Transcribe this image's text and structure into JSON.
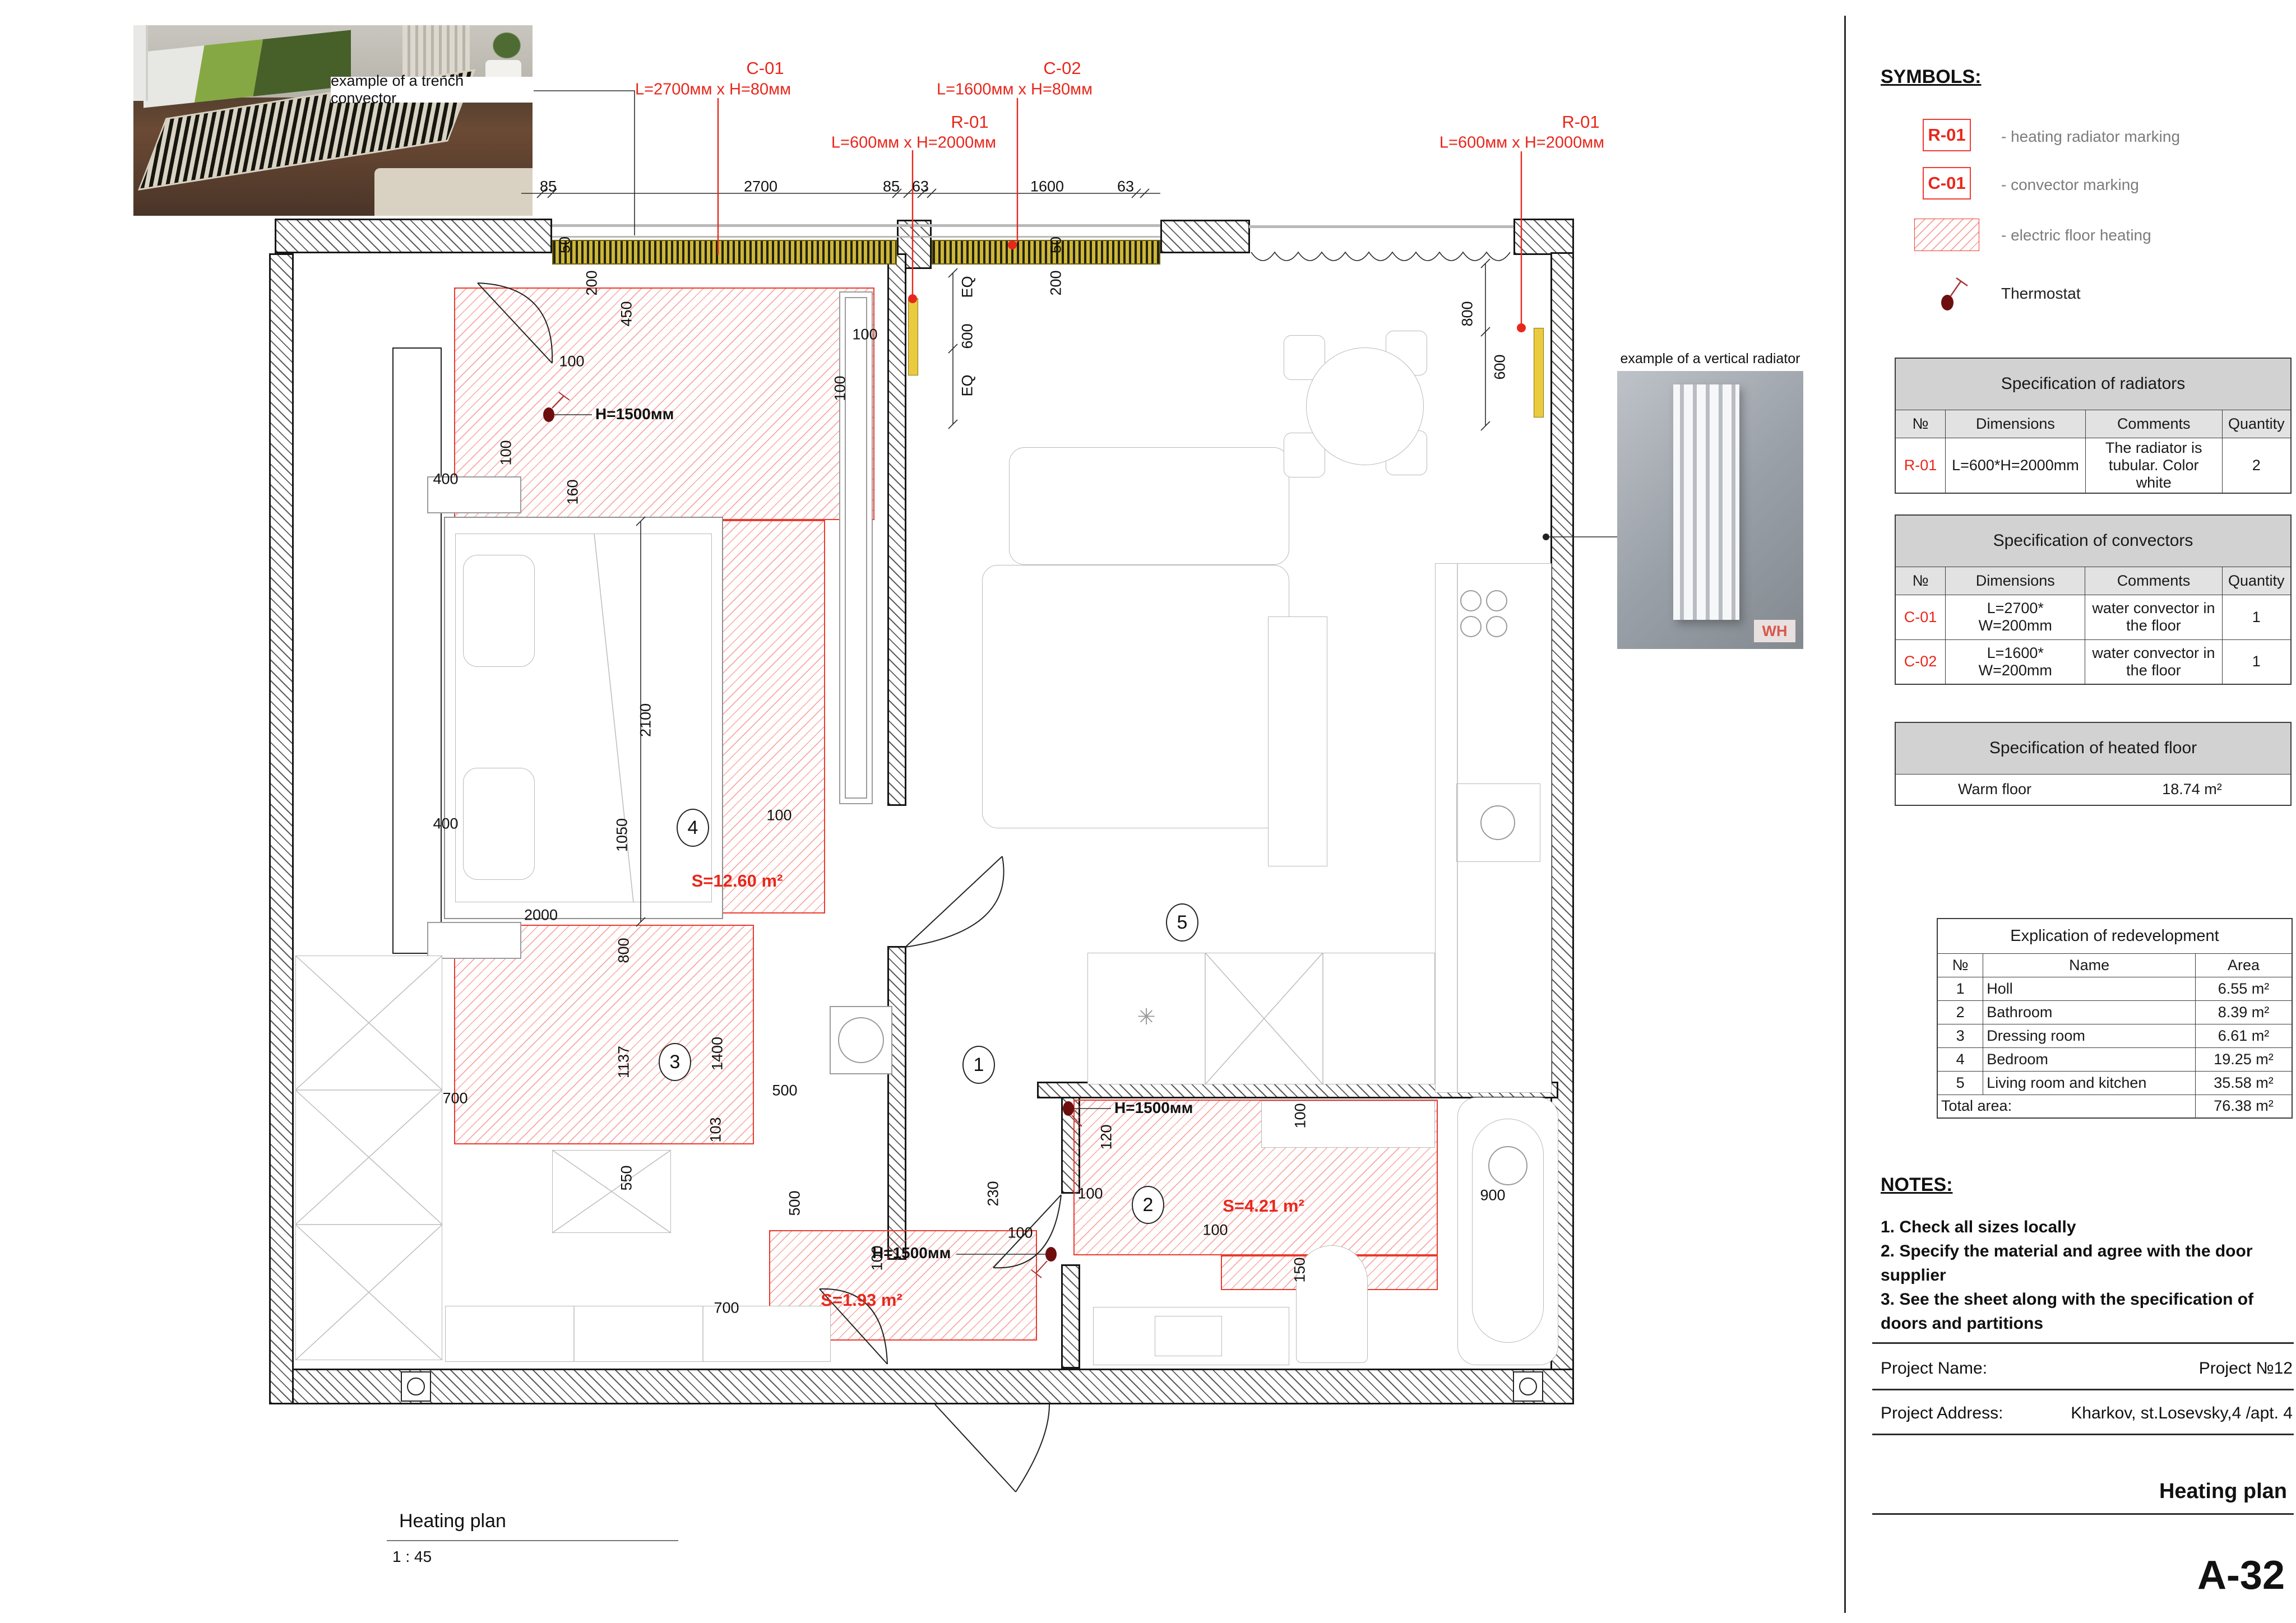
{
  "sheet": {
    "number": "A-32",
    "plan_title": "Heating plan",
    "plan_scale": "1 : 45"
  },
  "photos": {
    "trench_caption": "example of a trench convector",
    "vertical_caption": "example of a vertical radiator",
    "watermark": "WH"
  },
  "symbols": {
    "title": "SYMBOLS:",
    "radiator_code": "R-01",
    "radiator_label": "- heating radiator marking",
    "convector_code": "C-01",
    "convector_label": "- convector marking",
    "floor_label": "- electric floor heating",
    "thermostat_label": "Thermostat"
  },
  "tables": {
    "radiators": {
      "title": "Specification of radiators",
      "headers": [
        "№",
        "Dimensions",
        "Comments",
        "Quantity"
      ],
      "rows": [
        {
          "no": "R-01",
          "dim": "L=600*H=2000mm",
          "comment": "The radiator is tubular. Color white",
          "qty": "2"
        }
      ]
    },
    "convectors": {
      "title": "Specification of convectors",
      "headers": [
        "№",
        "Dimensions",
        "Comments",
        "Quantity"
      ],
      "rows": [
        {
          "no": "C-01",
          "dim": "L=2700* W=200mm",
          "comment": "water convector in the floor",
          "qty": "1"
        },
        {
          "no": "C-02",
          "dim": "L=1600* W=200mm",
          "comment": "water convector in the floor",
          "qty": "1"
        }
      ]
    },
    "heated_floor": {
      "title": "Specification of heated floor",
      "row_label": "Warm floor",
      "row_value": "18.74 m²"
    },
    "explication": {
      "title": "Explication of redevelopment",
      "headers": [
        "№",
        "Name",
        "Area"
      ],
      "rows": [
        [
          "1",
          "Holl",
          "6.55 m²"
        ],
        [
          "2",
          "Bathroom",
          "8.39 m²"
        ],
        [
          "3",
          "Dressing room",
          "6.61 m²"
        ],
        [
          "4",
          "Bedroom",
          "19.25 m²"
        ],
        [
          "5",
          "Living room and kitchen",
          "35.58 m²"
        ]
      ],
      "total_label": "Total area:",
      "total_value": "76.38 m²"
    }
  },
  "notes": {
    "title": "NOTES:",
    "line1": "1. Check all sizes locally",
    "line2": "2. Specify the material and agree with the door supplier",
    "line3": "3. See the sheet along with the specification of doors and partitions"
  },
  "titleblock": {
    "name_label": "Project Name:",
    "name_value": "Project №12",
    "address_label": "Project Address:",
    "address_value": "Kharkov, st.Losevsky,4 /apt. 4",
    "sheet_title": "Heating plan"
  },
  "plan": {
    "markings": {
      "c01": "C-01",
      "c01_dim": "L=2700мм x H=80мм",
      "c02": "C-02",
      "c02_dim": "L=1600мм x H=80мм",
      "r01": "R-01",
      "r01_dim": "L=600мм x H=2000мм"
    },
    "areas": {
      "bedroom": "S=12.60 m²",
      "hall": "S=1.93 m²",
      "bathroom": "S=4.21 m²"
    },
    "thermostat_height": "H=1500мм",
    "rooms": [
      "1",
      "2",
      "3",
      "4",
      "5"
    ],
    "dims": [
      "85",
      "2700",
      "85",
      "63",
      "1600",
      "63",
      "50",
      "200",
      "450",
      "100",
      "100",
      "160",
      "400",
      "2100",
      "400",
      "100",
      "100",
      "50",
      "200",
      "EQ",
      "600",
      "EQ",
      "800",
      "600",
      "100",
      "1050",
      "800",
      "2000",
      "1137",
      "1400",
      "103",
      "500",
      "700",
      "550",
      "500",
      "700",
      "100",
      "230",
      "100",
      "100",
      "120",
      "100",
      "100",
      "150",
      "900"
    ]
  },
  "colors": {
    "accent_red": "#e8271c",
    "hatch_red": "#f26158",
    "wall_dark": "#161616",
    "table_header": "#d2d2d2",
    "table_subheader": "#e2e2e2"
  }
}
